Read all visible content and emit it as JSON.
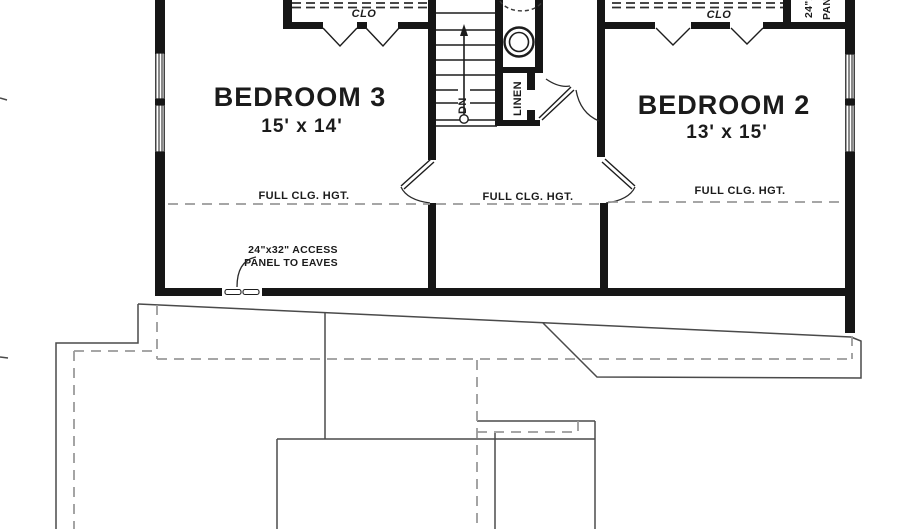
{
  "plan": {
    "rooms": [
      {
        "name": "BEDROOM 3",
        "dimensions": "15' x 14'"
      },
      {
        "name": "BEDROOM 2",
        "dimensions": "13' x 15'"
      }
    ],
    "closets": {
      "bedroom3_closet_label": "CLO",
      "bedroom2_closet_label": "CLO",
      "linen_label": "LINEN"
    },
    "stairs": {
      "direction_label": "DN"
    },
    "ceiling_notes": {
      "left": "FULL CLG. HGT.",
      "middle": "FULL CLG. HGT.",
      "right": "FULL CLG. HGT."
    },
    "access_note": {
      "line1": "24\"x32\" ACCESS",
      "line2": "PANEL TO EAVES"
    },
    "eaves_panel_note": {
      "line1": "24\"x32\" ACCESS",
      "line2": "PANEL TO EAVES"
    },
    "colors": {
      "wall": "#161616",
      "roof_lines": "#4a4a4a",
      "hidden_lines": "#9a9a9a",
      "background": "#ffffff"
    }
  }
}
